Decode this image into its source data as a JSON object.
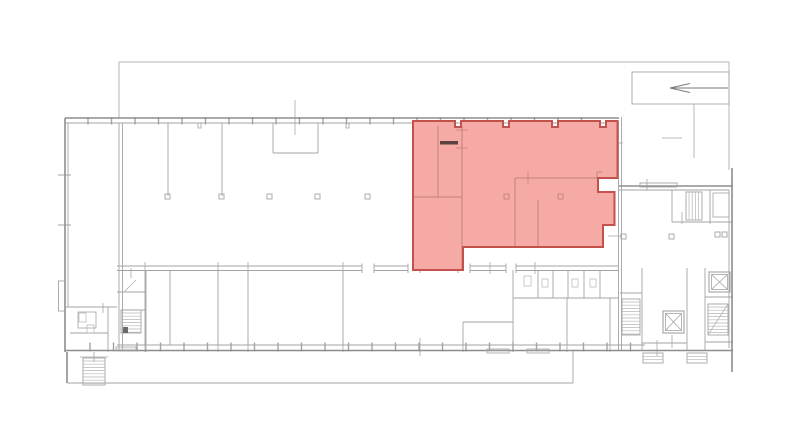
{
  "page": {
    "kind": "architectural-floor-plan",
    "background": "#ffffff"
  },
  "palette": {
    "wall_outer": "#8d8d8d",
    "wall_inner": "#a3a3a3",
    "wall_light": "#b5b5b5",
    "tick": "#a8a8a8",
    "highlight_fill": "#f6aaa5",
    "highlight_border": "#c4524c",
    "highlight_wall": "#c2827c",
    "dark_bar": "#5d4140",
    "arrow": "#7a7a7a"
  },
  "floorplan": {
    "canvas": {
      "w": 800,
      "h": 446
    },
    "yard_lines": [
      [
        119,
        62,
        729,
        62
      ],
      [
        119,
        62,
        119,
        118
      ],
      [
        729,
        62,
        729,
        170
      ]
    ],
    "arrow_box": {
      "rect": [
        632,
        72,
        97,
        32
      ],
      "shaft": [
        670,
        88,
        728,
        88
      ],
      "head": [
        [
          670,
          88,
          690,
          83.5
        ],
        [
          670,
          88,
          690,
          92.5
        ]
      ]
    },
    "walls_outer": [
      [
        65,
        118,
        619,
        118
      ],
      [
        65,
        118,
        65,
        352
      ],
      [
        65,
        350.5,
        733,
        350.5
      ],
      [
        619,
        186,
        733,
        186
      ],
      [
        732,
        168,
        732,
        372
      ],
      [
        67,
        352,
        67,
        383
      ]
    ],
    "walls_inner": [
      [
        65,
        123,
        619,
        123
      ],
      [
        117,
        345,
        645,
        345
      ],
      [
        119,
        123,
        119,
        351
      ],
      [
        122.5,
        123,
        122.5,
        351
      ],
      [
        618.5,
        121,
        618.5,
        351
      ],
      [
        621.5,
        117,
        621.5,
        351
      ],
      [
        619,
        190,
        729,
        190
      ],
      [
        729,
        190,
        729,
        348
      ],
      [
        68,
        123,
        68,
        307
      ],
      [
        168,
        123,
        168,
        196
      ],
      [
        222,
        123,
        222,
        196
      ],
      [
        273,
        123,
        273,
        153
      ],
      [
        318,
        123,
        318,
        153
      ],
      [
        273,
        153,
        318,
        153
      ],
      [
        145,
        270,
        145,
        345
      ],
      [
        170,
        270,
        170,
        345
      ],
      [
        218,
        270,
        218,
        345
      ],
      [
        248,
        270,
        248,
        345
      ],
      [
        343,
        270,
        343,
        345
      ],
      [
        463,
        322,
        463,
        345
      ],
      [
        463,
        322,
        513,
        322
      ],
      [
        513,
        270,
        513,
        345
      ],
      [
        513,
        298,
        618,
        298
      ],
      [
        538,
        270,
        538,
        298
      ],
      [
        553,
        270,
        553,
        298
      ],
      [
        568,
        270,
        568,
        298
      ],
      [
        584,
        270,
        584,
        298
      ],
      [
        600,
        270,
        600,
        298
      ],
      [
        567,
        298,
        567,
        345
      ],
      [
        610,
        298,
        610,
        345
      ],
      [
        65,
        307,
        117,
        307
      ],
      [
        70,
        333,
        108,
        333
      ],
      [
        108,
        307,
        108,
        352
      ],
      [
        117,
        292,
        146,
        292
      ],
      [
        146,
        270,
        146,
        352
      ],
      [
        121,
        310,
        146,
        310
      ],
      [
        672,
        190,
        672,
        222
      ],
      [
        672,
        222,
        733,
        222
      ],
      [
        710,
        190,
        710,
        222
      ],
      [
        642,
        268,
        642,
        351
      ],
      [
        687,
        268,
        687,
        351
      ],
      [
        705,
        268,
        705,
        351
      ],
      [
        620,
        293,
        642,
        293
      ],
      [
        642,
        343,
        687,
        343
      ],
      [
        705,
        297,
        733,
        297
      ],
      [
        705,
        342,
        733,
        342
      ]
    ],
    "gallery_lines": [
      [
        67,
        383,
        573,
        383
      ],
      [
        573,
        351,
        573,
        383
      ]
    ],
    "bump_rect": [
      58.5,
      281,
      7,
      30
    ],
    "parapet_rect": [
      640,
      183,
      37,
      4
    ],
    "facade_top": {
      "y1": 117,
      "y2": 124.5,
      "tick_start": 88,
      "tick_step": 23.5,
      "tick_end": 600
    },
    "facade_bottom": {
      "y1": 342.5,
      "y2": 351.5,
      "tick_start": 90,
      "tick_step": 23.5,
      "tick_end": 640
    },
    "left_wall_ticks": [
      [
        58,
        175,
        13
      ],
      [
        58,
        225,
        13
      ]
    ],
    "pilaster_stubs": [
      [
        198,
        123,
        3,
        5
      ],
      [
        346,
        123,
        3,
        5
      ]
    ],
    "corridor": {
      "y1": 266,
      "y2": 270.5,
      "x1": 117,
      "x2": 618,
      "gaps": [
        [
          362,
          374
        ],
        [
          408,
          420
        ],
        [
          458,
          470
        ],
        [
          506,
          516
        ]
      ],
      "jamb_y1": 263.5,
      "jamb_y2": 273
    },
    "stairs": [
      {
        "rect": [
          83,
          358,
          22,
          27
        ],
        "dir": "h"
      },
      {
        "rect": [
          121,
          310,
          20,
          23
        ],
        "dir": "h",
        "tip": [
          123,
          327,
          5,
          6
        ]
      },
      {
        "rect": [
          622,
          299,
          18,
          36
        ],
        "dir": "h"
      },
      {
        "rect": [
          708,
          304,
          20,
          31
        ],
        "dir": "h"
      },
      {
        "rect": [
          686,
          192,
          16,
          28
        ],
        "dir": "v"
      }
    ],
    "stair_diagonals": [
      [
        708,
        335,
        728,
        304
      ]
    ],
    "elevators": [
      [
        709,
        272,
        21,
        20
      ],
      [
        663,
        311,
        21,
        22
      ]
    ],
    "room_rects": [
      [
        78,
        312,
        18,
        16
      ],
      [
        713,
        193,
        16,
        24
      ]
    ],
    "pillars": [
      [
        165,
        194
      ],
      [
        219,
        194
      ],
      [
        267,
        194
      ],
      [
        315,
        194
      ],
      [
        365,
        194
      ],
      [
        621,
        234
      ],
      [
        669,
        234
      ],
      [
        715,
        232
      ],
      [
        722,
        232
      ]
    ],
    "fixtures": [
      [
        524,
        276,
        7,
        10
      ],
      [
        542,
        279,
        6,
        8
      ],
      [
        572,
        279,
        6,
        8
      ],
      [
        590,
        279,
        6,
        8
      ],
      [
        79,
        313,
        7,
        9
      ],
      [
        87,
        325,
        7,
        8
      ]
    ],
    "sills": [
      [
        116,
        347,
        20,
        4
      ],
      [
        487,
        349,
        22,
        4
      ],
      [
        527,
        349,
        22,
        4
      ]
    ],
    "entry_steps": [
      [
        643,
        353,
        20,
        10
      ],
      [
        687,
        353,
        20,
        10
      ]
    ],
    "door_diagonals": [
      [
        124,
        292,
        136,
        280
      ]
    ],
    "ticks_v": [
      [
        295,
        100,
        35
      ],
      [
        694,
        104,
        54
      ],
      [
        420,
        338,
        18
      ],
      [
        657,
        340,
        16
      ],
      [
        672,
        335,
        13
      ],
      [
        647,
        179,
        12
      ],
      [
        682,
        212,
        12
      ],
      [
        710,
        212,
        12
      ],
      [
        145,
        340,
        12
      ],
      [
        218,
        340,
        12
      ],
      [
        248,
        340,
        12
      ],
      [
        343,
        340,
        12
      ],
      [
        463,
        340,
        12
      ],
      [
        513,
        340,
        12
      ],
      [
        567,
        340,
        12
      ],
      [
        610,
        340,
        12
      ],
      [
        145,
        262,
        12
      ],
      [
        218,
        262,
        12
      ],
      [
        248,
        262,
        12
      ],
      [
        343,
        262,
        12
      ],
      [
        490,
        262,
        12
      ],
      [
        535,
        262,
        12
      ],
      [
        94,
        352,
        10
      ],
      [
        131,
        268,
        10
      ],
      [
        103,
        303,
        10
      ]
    ],
    "ticks_h": [
      [
        58,
        175,
        13
      ],
      [
        58,
        225,
        13
      ],
      [
        610,
        143,
        13
      ],
      [
        608,
        236,
        14
      ],
      [
        662,
        138,
        20
      ],
      [
        80,
        357,
        28
      ]
    ],
    "highlight": {
      "points": "413,121 455,121 455,127 461,127 461,121 503,121 503,127 509,127 509,121 552,121 552,127 558,127 558,121 600,121 600,127 606,127 606,121 617.5,121 617.5,178 598,178 598,192 614.5,192 614.5,225 603,225 603,247 463,247 463,270 413,270",
      "interior_walls": [
        [
          438,
          126,
          438,
          197
        ],
        [
          462,
          126,
          462,
          270
        ],
        [
          413,
          197,
          462,
          197
        ],
        [
          515,
          178,
          597,
          178
        ],
        [
          597,
          172,
          597,
          178
        ],
        [
          597,
          172,
          602,
          172
        ],
        [
          515,
          178,
          515,
          247
        ],
        [
          538,
          200,
          538,
          247
        ]
      ],
      "pillars": [
        [
          504,
          194
        ],
        [
          558,
          194
        ]
      ],
      "dark_bar": [
        440,
        141,
        18,
        3.5
      ],
      "ticks_h": [
        [
          456,
          130,
          12
        ],
        [
          456,
          148,
          12
        ]
      ],
      "ticks_v": [
        [
          528,
          172,
          12
        ]
      ]
    }
  }
}
